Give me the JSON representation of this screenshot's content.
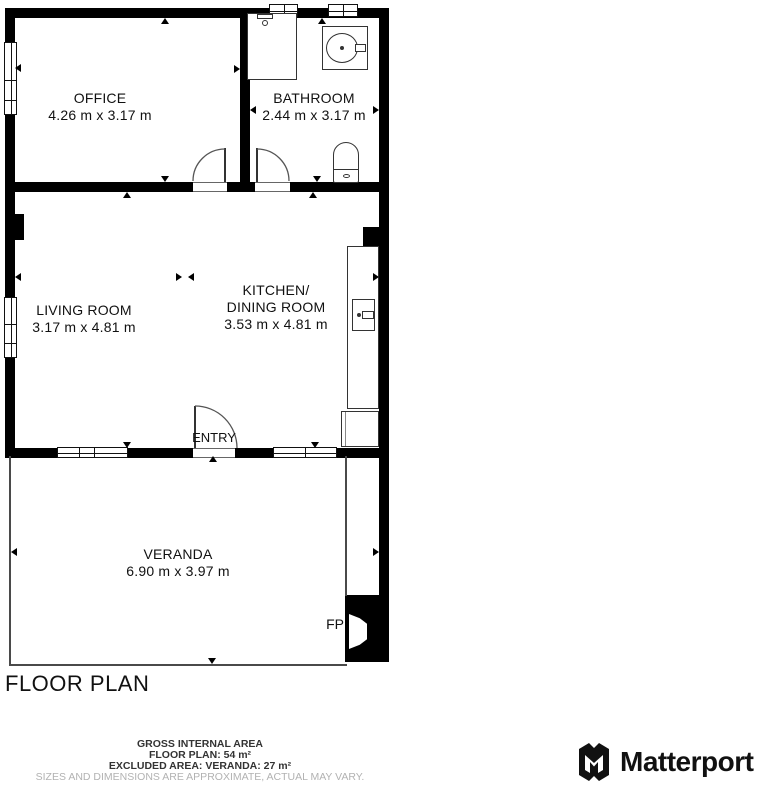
{
  "plan": {
    "title": "FLOOR PLAN",
    "rooms": [
      {
        "name": "OFFICE",
        "dims": "4.26 m x 3.17 m"
      },
      {
        "name": "BATHROOM",
        "dims": "2.44 m x 3.17 m"
      },
      {
        "name": "LIVING ROOM",
        "dims": "3.17 m x 4.81 m"
      },
      {
        "name": "KITCHEN/",
        "name2": "DINING ROOM",
        "dims": "3.53 m x 4.81 m"
      },
      {
        "name": "VERANDA",
        "dims": "6.90 m x 3.97 m"
      }
    ],
    "entry_label": "ENTRY",
    "fireplace_label": "FP"
  },
  "footer": {
    "area_heading": "GROSS INTERNAL AREA",
    "floor_plan_area": "FLOOR PLAN: 54 m²",
    "excluded_area": "EXCLUDED AREA: VERANDA: 27 m²",
    "disclaimer": "SIZES AND DIMENSIONS ARE APPROXIMATE, ACTUAL MAY VARY."
  },
  "brand": {
    "wordmark": "Matterport",
    "icon": "matterport-m-icon"
  },
  "colors": {
    "wall": "#000000",
    "background": "#ffffff",
    "thin_line": "#4a4a4a",
    "label_text": "#1a1a1a",
    "disclaimer_text": "#b2b2b2"
  }
}
